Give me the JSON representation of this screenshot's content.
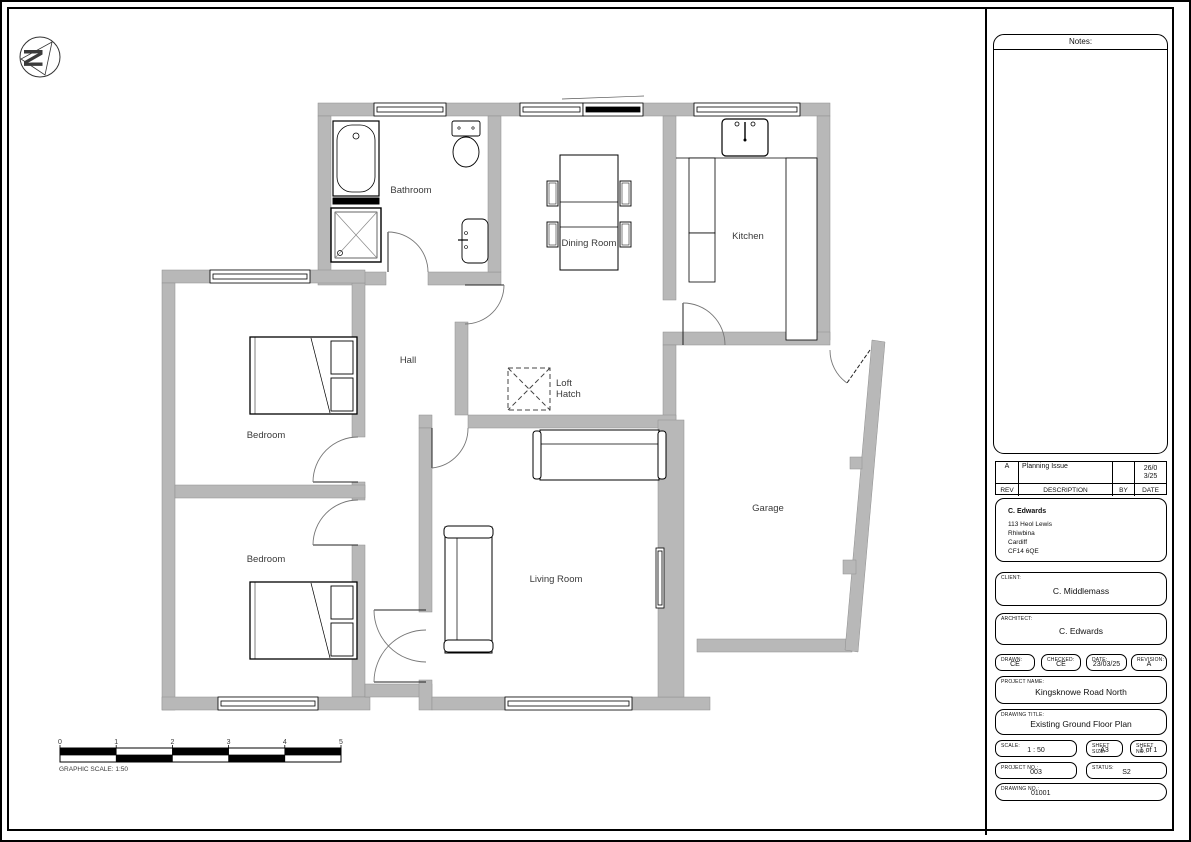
{
  "north_label": "N",
  "rooms": {
    "bathroom": "Bathroom",
    "dining": "Dining Room",
    "kitchen": "Kitchen",
    "hall": "Hall",
    "loft_line1": "Loft",
    "loft_line2": "Hatch",
    "bedroom1": "Bedroom",
    "bedroom2": "Bedroom",
    "living": "Living Room",
    "garage": "Garage"
  },
  "scale_bar": {
    "ticks": [
      "0",
      "1",
      "2",
      "3",
      "4",
      "5"
    ],
    "caption": "GRAPHIC SCALE: 1:50"
  },
  "titleblock": {
    "notes_label": "Notes:",
    "revision_table": {
      "headers": {
        "rev": "REV",
        "description": "DESCRIPTION",
        "by": "BY",
        "date": "DATE"
      },
      "rows": [
        {
          "rev": "A",
          "description": "Planning Issue",
          "by": "",
          "date": "26/03/25",
          "date_display": [
            "26/0",
            "3/25"
          ]
        }
      ]
    },
    "client_info": {
      "name": "C. Edwards",
      "address": [
        "113 Heol Lewis",
        "Rhiwbina",
        "Cardiff",
        "CF14 6QE"
      ]
    },
    "client": {
      "label": "CLIENT:",
      "value": "C. Middlemass"
    },
    "architect": {
      "label": "ARCHITECT:",
      "value": "C. Edwards"
    },
    "drawn": {
      "label": "DRAWN:",
      "value": "CE"
    },
    "checked": {
      "label": "CHECKED:",
      "value": "CE"
    },
    "date": {
      "label": "DATE:",
      "value": "23/03/25"
    },
    "revision": {
      "label": "REVISION:",
      "value": "A"
    },
    "project_name": {
      "label": "PROJECT NAME:",
      "value": "Kingsknowe Road North"
    },
    "drawing_title": {
      "label": "DRAWING TITLE:",
      "value": "Existing Ground Floor Plan"
    },
    "scale": {
      "label": "SCALE:",
      "value": "1 : 50"
    },
    "sheet_size": {
      "label": "SHEET SIZE:",
      "value": "A3"
    },
    "sheet_no": {
      "label": "SHEET NO.:",
      "value": "1 of 1"
    },
    "project_no": {
      "label": "PROJECT NO.:",
      "value": "003"
    },
    "status": {
      "label": "STATUS:",
      "value": "S2"
    },
    "drawing_no": {
      "label": "DRAWING NO.:",
      "value": "01001"
    }
  }
}
